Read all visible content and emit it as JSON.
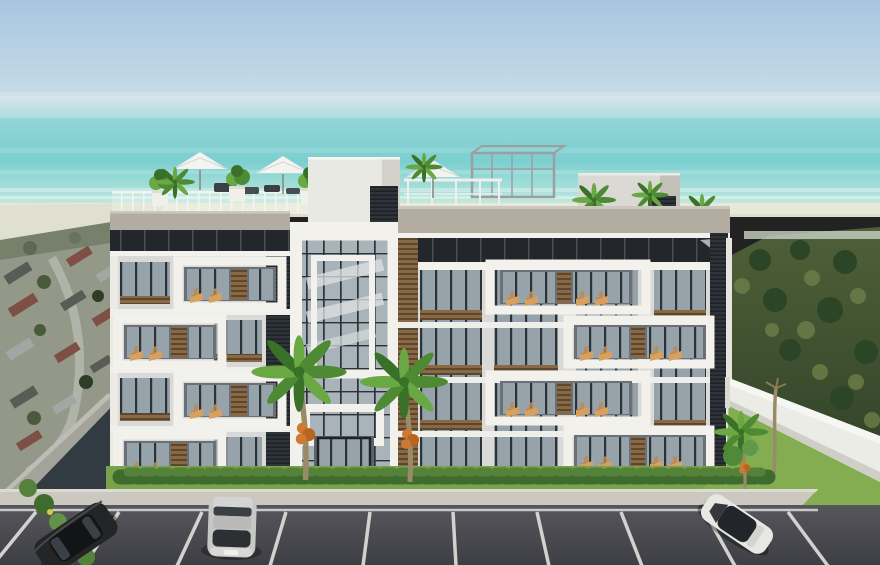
{
  "scene": {
    "title": "Aerial 3D rendering of a modern white beachfront apartment building with rooftop terrace, palm trees, hedge, and a parking lot with three parked cars; turquoise ocean and hazy sky behind, residential neighborhood to the left, green hillside with white perimeter wall to the right",
    "objects": [
      {
        "name": "sky",
        "label": "hazy light-blue sky"
      },
      {
        "name": "ocean",
        "label": "turquoise sea with soft horizon"
      },
      {
        "name": "beach",
        "label": "pale sand shoreline"
      },
      {
        "name": "neighborhood-left",
        "label": "aerial residential rooftops with street"
      },
      {
        "name": "hillside-right",
        "label": "green tree-covered hill"
      },
      {
        "name": "perimeter-wall",
        "label": "white boundary wall"
      },
      {
        "name": "apartment-building",
        "label": "4-storey white building, staggered balcony frames, wood-slat accents"
      },
      {
        "name": "rooftop-terrace",
        "label": "roof deck with white umbrellas, planters, loungers, pergola"
      },
      {
        "name": "palm-trees",
        "label": "coconut palms with orange fruit"
      },
      {
        "name": "entrance",
        "label": "central glass stairwell and entry doors"
      },
      {
        "name": "hedge",
        "label": "green hedge along facade"
      },
      {
        "name": "sidewalk",
        "label": "light concrete walkway"
      },
      {
        "name": "parking-lot",
        "label": "dark asphalt with white stall lines"
      },
      {
        "name": "car-dark",
        "label": "dark gray SUV, angled, bottom left"
      },
      {
        "name": "car-silver",
        "label": "silver SUV seen from rear-top, center"
      },
      {
        "name": "car-white",
        "label": "white car with black glass roof, right"
      }
    ]
  },
  "palette": {
    "sky_top": "#a7c6e0",
    "sky_horizon": "#cfe0e8",
    "sea_far": "#8fd4d6",
    "sea_mid": "#7ccfd0",
    "sea_near": "#b2e4dc",
    "sand": "#e8e8d8",
    "shore_veg": "#76806b",
    "foliage_dark": "#33452a",
    "foliage_mid": "#4f6038",
    "foliage_light": "#6d7f48",
    "neighborhood": "#939888",
    "road": "#b4b6ac",
    "roof_red": "#7e4f45",
    "roof_dark": "#585c55",
    "roof_light": "#a3a7a3",
    "concrete": "#a3a39b",
    "ramp": "#333b42",
    "bldg_white": "#f2f1ec",
    "bldg_body": "#d9dad8",
    "bldg_shade": "#c9c8c1",
    "parapet": "#b2aca1",
    "band_dark": "#23272b",
    "band_line": "#4a5156",
    "glass": "#97a3ab",
    "glass_dark": "#6b7077",
    "frame_dark": "#2d3237",
    "wood": "#8a6844",
    "wood_dark": "#3c2f1e",
    "slat_dark": "#2f343a",
    "cushion": "#d8a05e",
    "umbrella": "#f3f3ef",
    "palm_green": "#4e8a33",
    "palm_green2": "#6aa844",
    "palm_green3": "#3a7128",
    "coconut": "#cf7a33",
    "trunk": "#9b8a68",
    "lawn": "#79a24b",
    "hedge": "#3f6b2e",
    "hedge_hi": "#54823a",
    "grass_right": "#84ad52",
    "wall_white": "#ecece6",
    "wall_shade": "#cfcfc8",
    "sidewalk": "#cbc8c0",
    "asphalt": "#56565c",
    "asphalt_deep": "#3e3f45",
    "line_white": "#dededa",
    "car_dark": "#232527",
    "car_dark_roof": "#121416",
    "car_silver": "#c7c8c6",
    "car_white": "#e7e7e4",
    "car_glass": "#22262a",
    "pergola_metal": "#9aa0a2"
  }
}
